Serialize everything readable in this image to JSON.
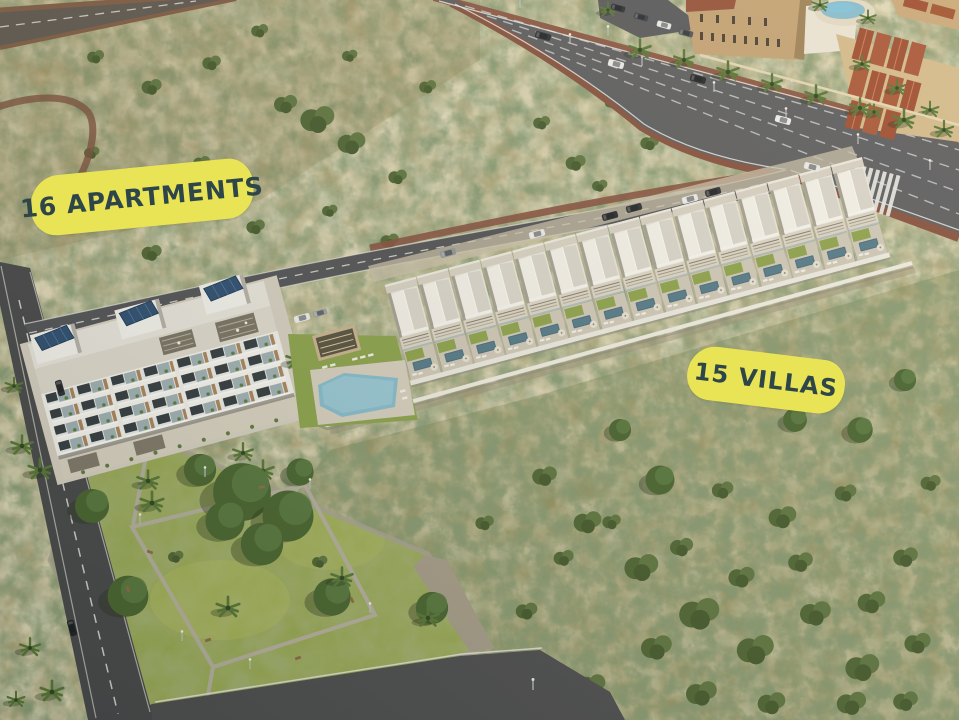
{
  "annotations": {
    "apartments_label": "16 APARTMENTS",
    "villas_label": "15 VILLAS"
  },
  "development": {
    "apartments_count": 16,
    "villas_count": 15
  },
  "palette": {
    "label_bg": "#e9e455",
    "label_text": "#2e4649",
    "scrub_base": "#a89c6e",
    "park_grass": "#96a84e",
    "asphalt": "#5b5c60",
    "sidewalk_red": "#84503f",
    "building_white": "#efede7",
    "pool_blue": "#86bccf",
    "solar_panel_blue": "#2b4d72",
    "roof_red": "#9e4c31"
  }
}
